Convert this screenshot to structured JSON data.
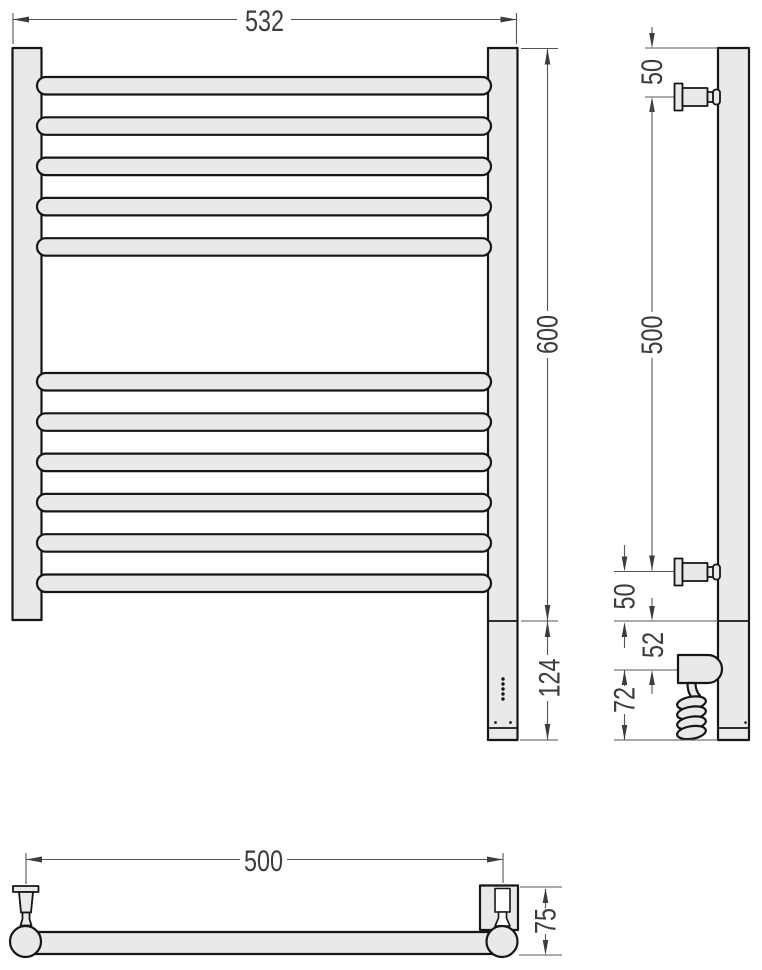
{
  "front_view": {
    "width": "532",
    "height": "600",
    "heater_section_height": "124"
  },
  "side_view": {
    "top_bracket_offset": "50",
    "bracket_spacing": "500",
    "bottom_bracket_offset": "50",
    "collar_height": "52",
    "heater_depth": "72"
  },
  "plan_view": {
    "bracket_spacing": "500",
    "wall_depth": "75"
  },
  "colors": {
    "part_fill": "#e9e9e9",
    "outline": "#161616",
    "dimension_line": "#555555",
    "dimension_text": "#3d3d3d",
    "background": "#ffffff"
  }
}
